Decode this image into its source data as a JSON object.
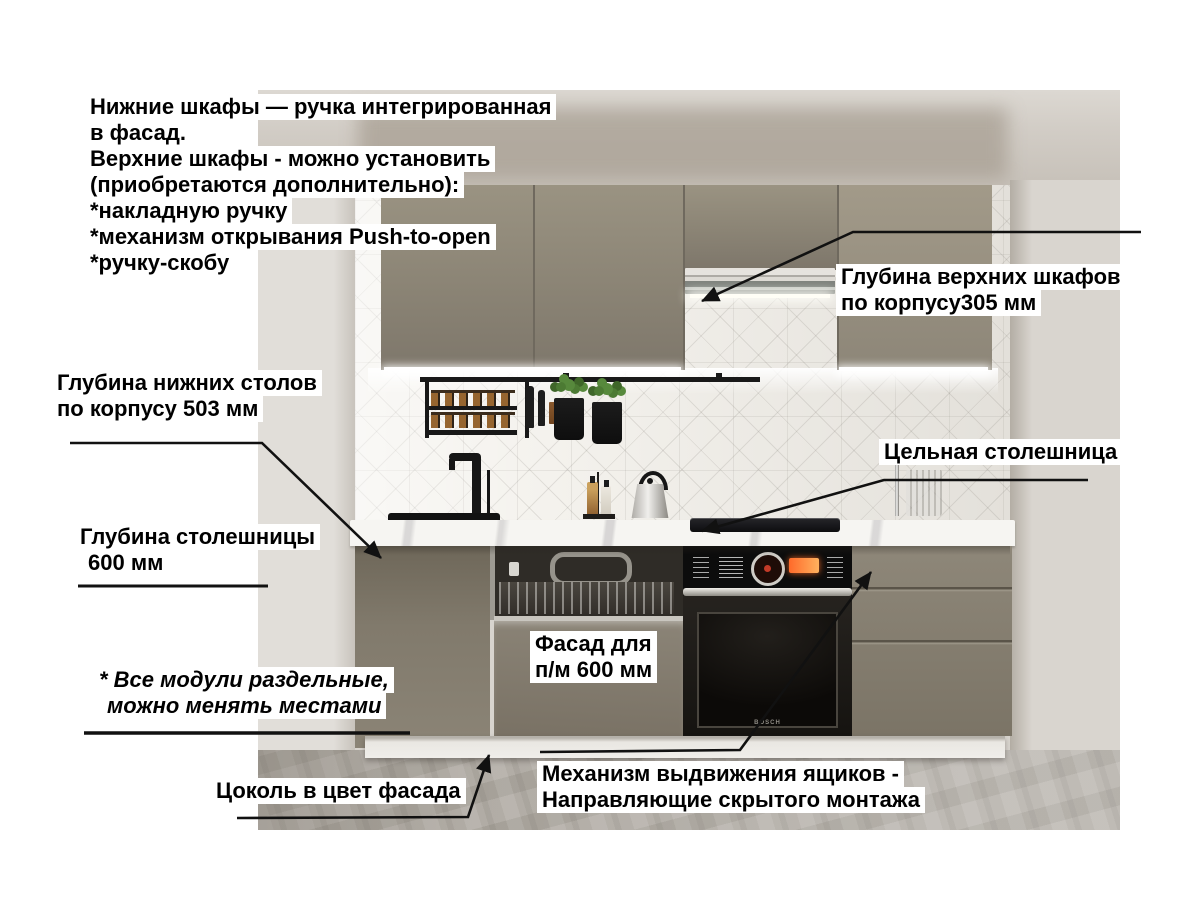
{
  "callouts": {
    "handles_note": {
      "lines": [
        "Нижние шкафы — ручка интегрированная",
        "в фасад.",
        "Верхние шкафы - можно установить",
        "(приобретаются дополнительно):",
        "*накладную ручку",
        "*механизм открывания Push-to-open",
        "*ручку-скобу"
      ]
    },
    "upper_cabinet_depth": {
      "lines": [
        "Глубина верхних шкафов",
        "по корпусу305 мм"
      ]
    },
    "base_cabinet_depth": {
      "lines": [
        "Глубина нижних столов",
        "по корпусу 503 мм"
      ]
    },
    "countertop_depth": {
      "lines": [
        "Глубина столешницы",
        "600 мм"
      ]
    },
    "solid_countertop": {
      "label": "Цельная столешница"
    },
    "dishwasher_facade": {
      "lines": [
        "Фасад для",
        "п/м 600 мм"
      ]
    },
    "modules_note": {
      "lines": [
        "* Все модули раздельные,",
        "можно менять местами"
      ]
    },
    "plinth_note": {
      "label": "Цоколь в цвет фасада"
    },
    "drawer_slides": {
      "lines": [
        "Механизм выдвижения ящиков -",
        "Направляющие скрытого монтажа"
      ]
    }
  },
  "scene": {
    "oven_brand_label": "BOSCH"
  },
  "colors": {
    "facade_taupe": "#8a8376",
    "countertop_white": "#f6f5f2",
    "backsplash_tile": "#f4f2ed",
    "wall_grey": "#d8d4ce",
    "floor_concrete": "#aba69e",
    "annotation_text": "#000000",
    "annotation_background": "#ffffff",
    "leader_line": "#111111"
  }
}
